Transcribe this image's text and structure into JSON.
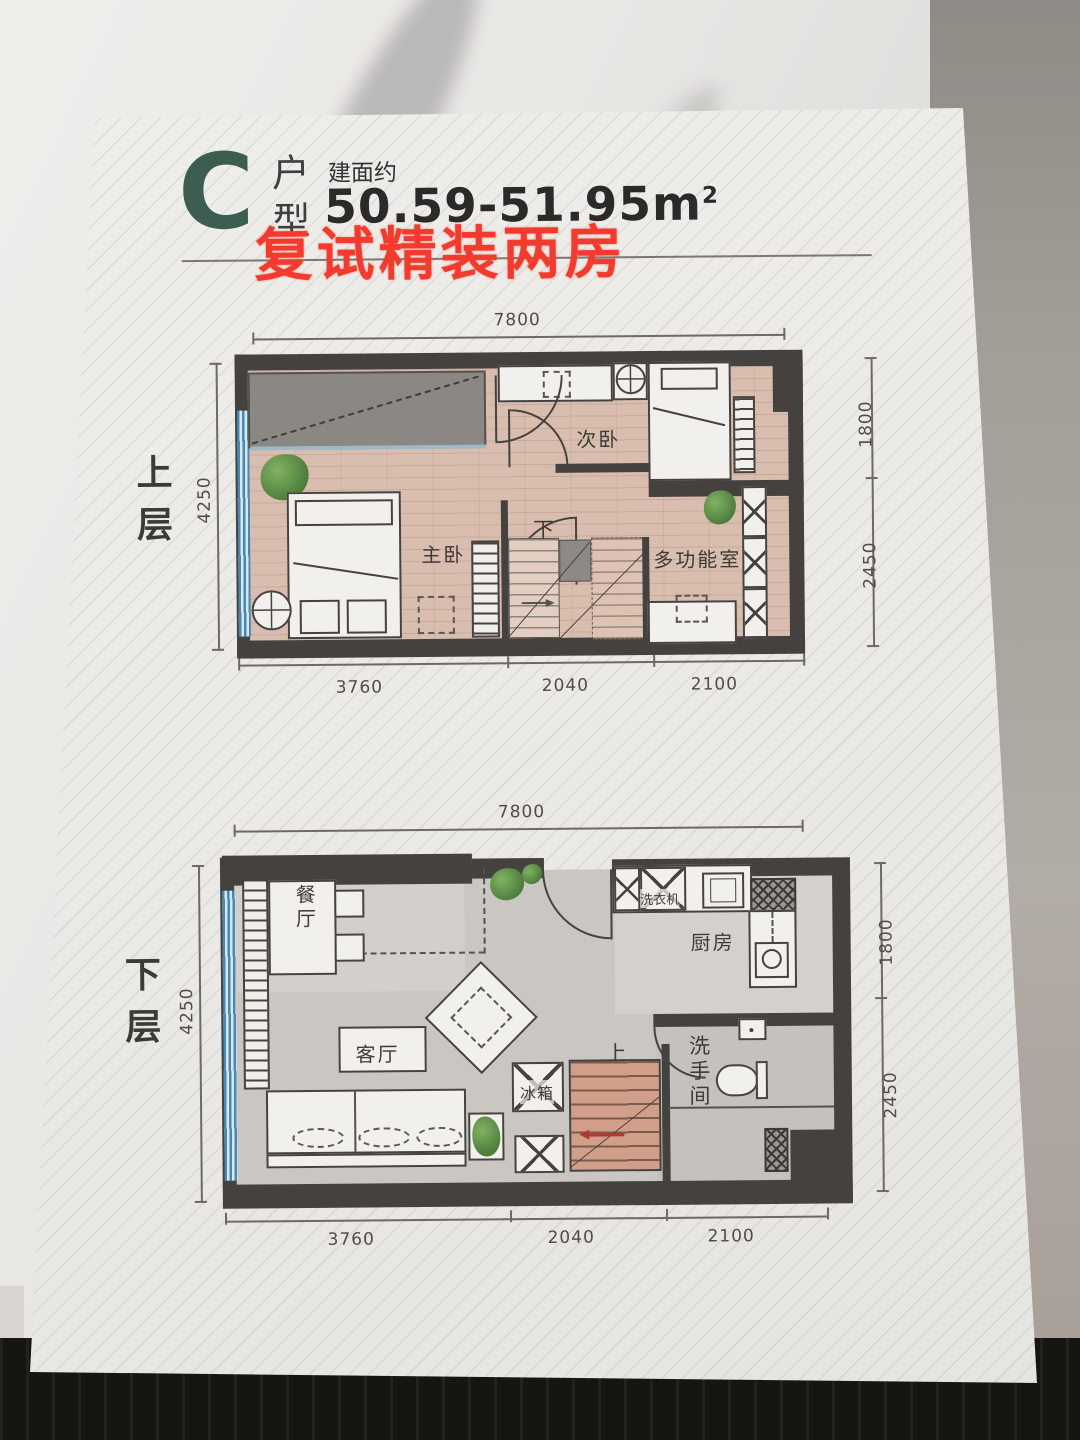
{
  "header": {
    "type_letter": "C",
    "type_label_top": "户",
    "type_label_bottom": "型",
    "area_prefix": "建面约",
    "area_value": "50.59-51.95m",
    "area_exponent": "2",
    "overlay_title": "复试精装两房"
  },
  "floors": [
    {
      "side_label": "上层",
      "dims": {
        "top": "7800",
        "left": "4250",
        "right_upper": "1800",
        "right_lower": "2450",
        "bottom": [
          "3760",
          "2040",
          "2100"
        ]
      },
      "rooms": {
        "master": "主卧",
        "secondary": "次卧",
        "multi": "多功能室",
        "stair": "下"
      }
    },
    {
      "side_label": "下层",
      "dims": {
        "top": "7800",
        "left": "4250",
        "right_upper": "1800",
        "right_lower": "2450",
        "bottom": [
          "3760",
          "2040",
          "2100"
        ]
      },
      "rooms": {
        "dining": "餐厅",
        "living": "客厅",
        "kitchen": "厨房",
        "washer": "洗衣机",
        "fridge": "冰箱",
        "bath": "洗手间",
        "stair": "上"
      }
    }
  ],
  "colors": {
    "accent_green": "#3c5e50",
    "overlay_red": "#f23b2e",
    "wall": "#44413e",
    "wood_floor": "#d9bdaf",
    "glazing_blue": "#4a88b4"
  }
}
